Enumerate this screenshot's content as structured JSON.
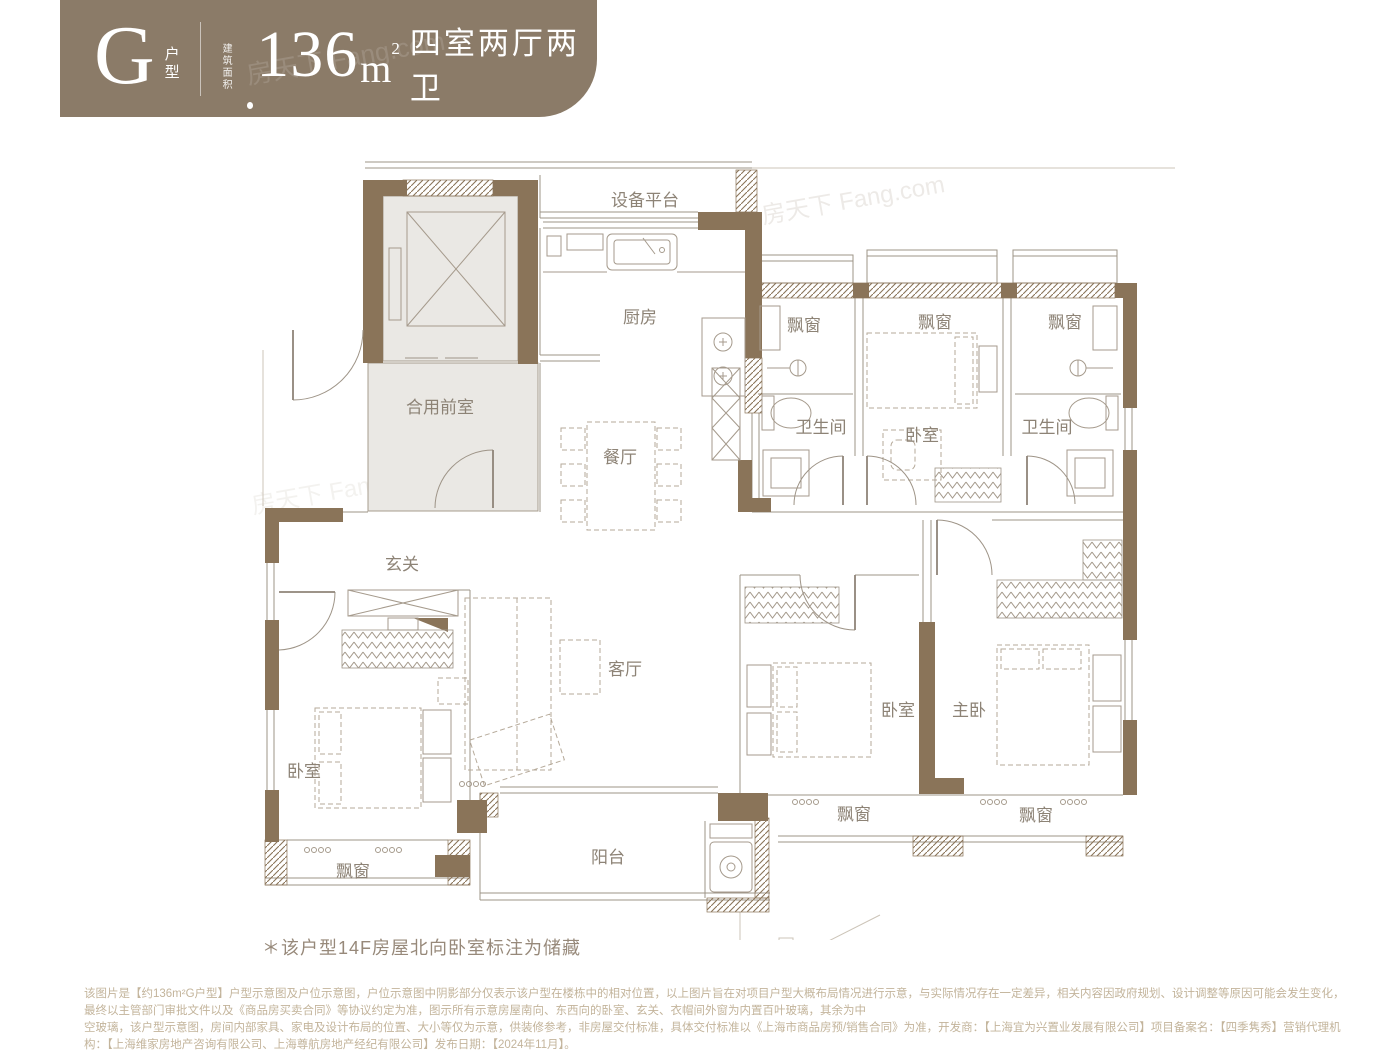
{
  "header": {
    "type_letter": "G",
    "type_label": "户型",
    "area_label_line1": "建筑",
    "area_label_line2": "面积",
    "area_value": "136",
    "area_unit_base": "m",
    "area_unit_sup": "2",
    "layout_text": "四室两厅两卫",
    "bg_color": "#8b7b68",
    "text_color": "#ffffff"
  },
  "floorplan": {
    "wall_color": "#8a7459",
    "line_color": "#9e9487",
    "label_color": "#8d8376",
    "core_fill": "#eae8e4",
    "rooms": [
      {
        "label": "设备平台"
      },
      {
        "label": "厨房"
      },
      {
        "label": "合用前室"
      },
      {
        "label": "餐厅"
      },
      {
        "label": "飘窗"
      },
      {
        "label": "飘窗"
      },
      {
        "label": "飘窗"
      },
      {
        "label": "卫生间"
      },
      {
        "label": "卧室"
      },
      {
        "label": "卫生间"
      },
      {
        "label": "玄关"
      },
      {
        "label": "客厅"
      },
      {
        "label": "卧室"
      },
      {
        "label": "卧室"
      },
      {
        "label": "主卧"
      },
      {
        "label": "阳台"
      },
      {
        "label": "飘窗"
      },
      {
        "label": "飘窗"
      },
      {
        "label": "飘窗"
      }
    ]
  },
  "footnote": {
    "text": "＊该户型14F房屋北向卧室标注为储藏"
  },
  "disclaimer": {
    "line1": "该图片是【约136m²G户型】户型示意图及户位示意图，户位示意图中阴影部分仅表示该户型在楼栋中的相对位置，以上图片旨在对项目户型大概布局情况进行示意，与实际情况存在一定差异，相关内容因政府规划、设计调整等原因可能会发生变化，最终以主管部门审批文件以及《商品房买卖合同》等协议约定为准，图示所有示意房屋南向、东西向的卧室、玄关、衣帽间外窗为内置百叶玻璃，其余为中",
    "line2": "空玻璃，该户型示意图，房间内部家具、家电及设计布局的位置、大小等仅为示意，供装修参考，非房屋交付标准，具体交付标准以《上海市商品房预/销售合同》为准，开发商：【上海宜为兴置业发展有限公司】项目备案名：【四季隽秀】营销代理机构：【上海维家房地产咨询有限公司、上海尊航房地产经纪有限公司】发布日期：【2024年11月】。"
  },
  "watermark": {
    "text": "房天下 Fang.com"
  }
}
